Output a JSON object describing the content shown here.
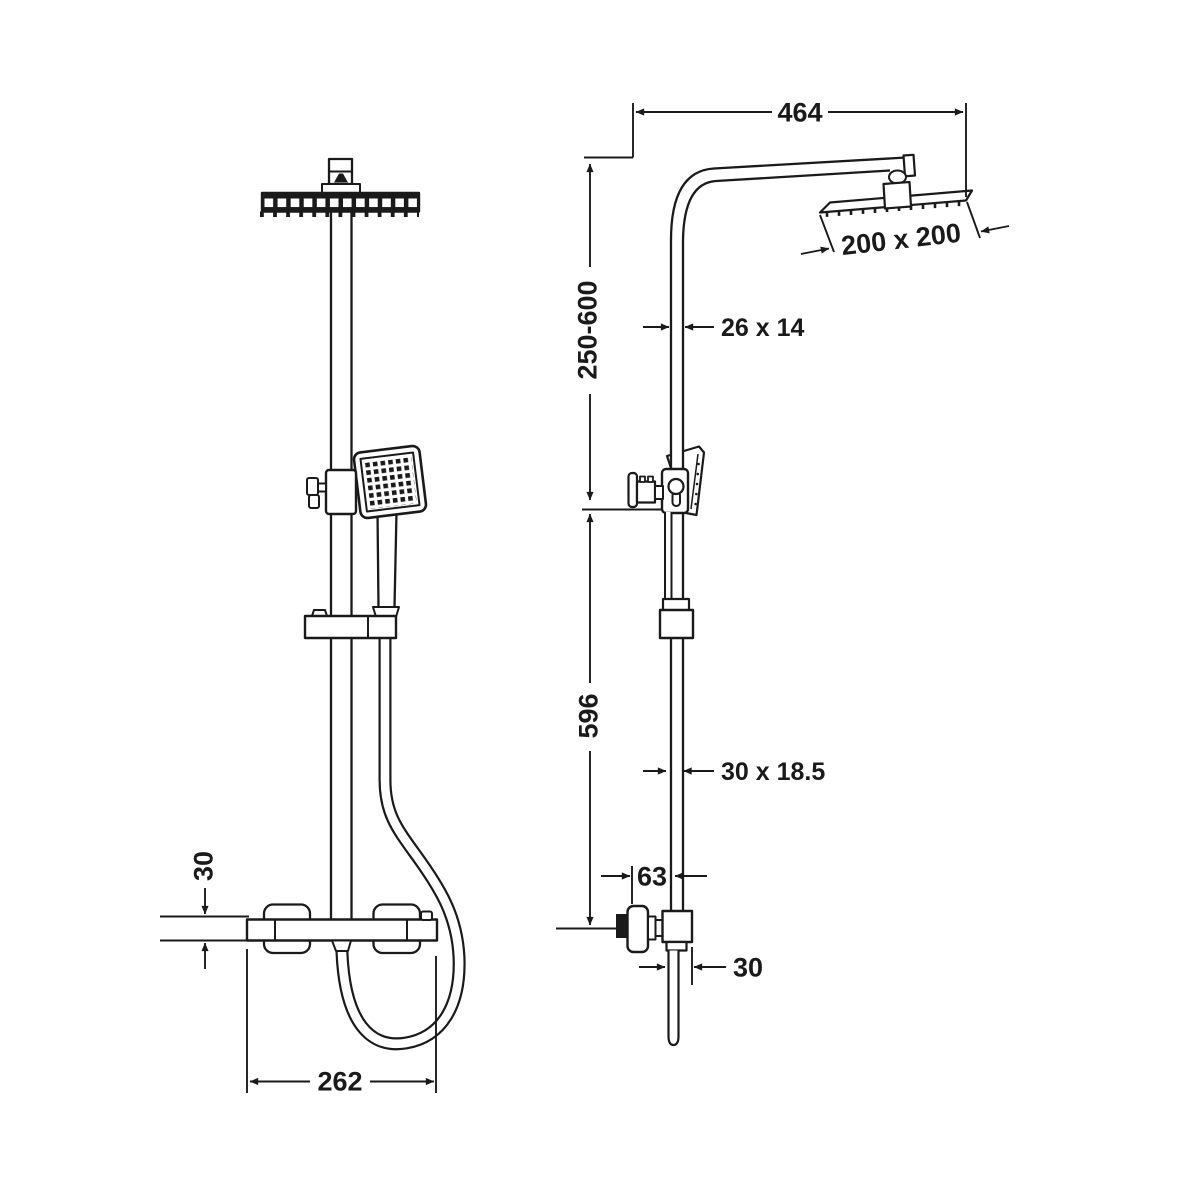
{
  "colors": {
    "background": "#ffffff",
    "line": "#1a1a1a",
    "text": "#1a1a1a"
  },
  "views": {
    "front": {
      "dims": {
        "valve_height": "30",
        "valve_width": "262"
      }
    },
    "side": {
      "dims": {
        "arm_width": "464",
        "head_plate": "200 x 200",
        "upper_tube_section": "26 x 14",
        "riser_height_range": "250-600",
        "rail_length": "596",
        "rail_section": "30 x 18.5",
        "holder_offset": "63",
        "outlet_depth": "30"
      }
    }
  }
}
